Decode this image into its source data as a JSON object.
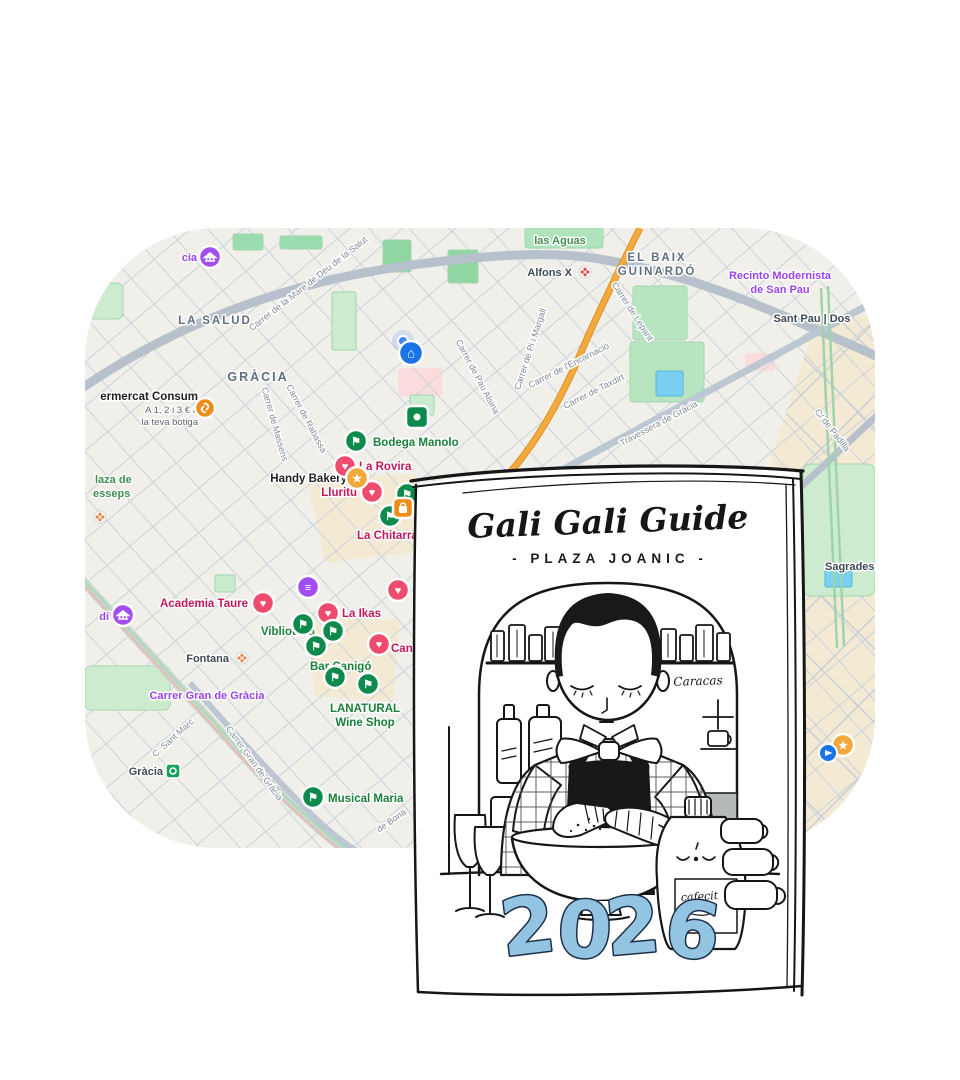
{
  "page": {
    "background": "#ffffff"
  },
  "map": {
    "type": "google-maps-crop",
    "colors": {
      "background": "#f1efe9",
      "street_grid": "#cbd5dd",
      "major_road": "#b6c1cc",
      "road_medium": "#bcc7d2",
      "highlight_road": "#f2a93d",
      "park": "#b7e5c0",
      "park_bright": "#8fd6a2",
      "park_pale": "#cdeccf",
      "water": "#79d0f0",
      "commercial_area": "#f4e9d2",
      "pink_block": "#fbdcdc",
      "railway": "#ccd6d1",
      "marker_pink": "#ee4b6e",
      "marker_green": "#0f8a4d",
      "marker_star": "#f2a83a",
      "marker_purple": "#a14df0",
      "marker_blue": "#1a73e8",
      "marker_orange": "#f08c1a",
      "location_dot": "#4285f4",
      "label_green": "#188038",
      "label_pink": "#c2185b",
      "label_purple": "#9a43ea",
      "label_dark": "#202124",
      "label_transit": "#3e4a55",
      "label_neighborhood": "#5f6e7d",
      "label_street": "#7f8b96"
    },
    "neighborhoods": {
      "la_salud": "LA SALUD",
      "gracia": "GRÀCIA",
      "baix_l1": "EL BAIX",
      "baix_l2": "GUINARDÓ"
    },
    "green_labels": {
      "las_aguas": "las Aguas",
      "lesseps_l1": "laza de",
      "lesseps_l2": "esseps"
    },
    "purple_labels": {
      "recinto_l1": "Recinto Modernista",
      "recinto_l2": "de San Pau",
      "gran_de_gracia": "Carrer Gran de Gràcia",
      "vicens_fragment": "dí",
      "topleft_fragment": "cia"
    },
    "transit_labels": {
      "alfons_x": "Alfons X",
      "sant_pau": "Sant Pau | Dos",
      "sagrades": "Sagrades",
      "fontana": "Fontana",
      "gracia_station": "Gràcia"
    },
    "ad": {
      "l1": "ermercat Consum",
      "l2": "A 1, 2 i 3 € a",
      "l3": "la teva botiga"
    },
    "pois_green": {
      "bodega_manolo": "Bodega Manolo",
      "viblioteca": "Viblioteca",
      "lanatural_l1": "LANATURAL",
      "lanatural_l2": "Wine Shop",
      "bar_canigo": "Bar Canigó",
      "musical_maria": "Musical Maria"
    },
    "pois_pink": {
      "la_rovira": "La Rovira",
      "lluritu": "Lluritu",
      "la_chitarra": "La Chitarra",
      "academia_taure": "Academia Taure",
      "la_ikas": "La Ikas",
      "canariz_wine": "Canariz Wine"
    },
    "pois_dark": {
      "handy_bakery": "Handy Bakery"
    },
    "streets": {
      "mare_de_deu": "Carrer de la Mare de Déu de la Salut",
      "pi_i_margall": "Carrer de Pi i Margall",
      "pau_alsina": "Carrer de Pau Alsina",
      "encarnacio": "Carrer de l'Encarnació",
      "taxdirt": "Carrer de Taxdirt",
      "lepant": "Carrer de Lepant",
      "travessera": "Travessera de Gràcia",
      "padilla": "C/ de Padilla",
      "rabassa": "Carrer de Rabassa",
      "massens": "Carrer de Massens",
      "sant_marc": "C. Sant Marc",
      "gran_de_gracia_street": "Carrer Gran de Gràcia",
      "de_bona_fragment": "de Bona"
    }
  },
  "icons": {
    "heart": "♥",
    "flag": "⚑",
    "star": "★",
    "home": "⌂",
    "book": "≡"
  },
  "poster": {
    "title": "Gali Gali Guide",
    "subtitle": "- PLAZA JOANIC -",
    "machine_brand": "Caracas",
    "jug_label": "cafecit",
    "year": "2026",
    "year_d1": "2",
    "year_d2": "0",
    "year_d3": "2",
    "year_d4": "6",
    "year_color": "#93c5e3"
  }
}
